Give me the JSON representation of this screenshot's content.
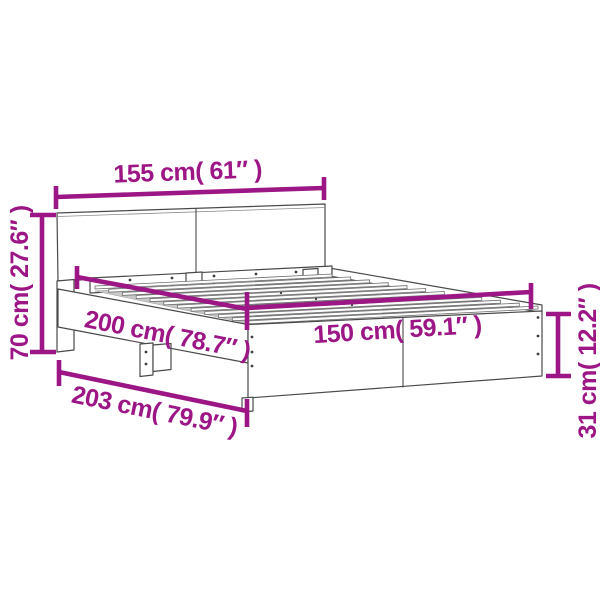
{
  "figure": {
    "subject": "Bed frame with headboard — product dimension diagram",
    "background_color": "#ffffff",
    "annotation_color": "#9c1685",
    "outline_color": "#4a4a4a"
  },
  "dimensions": [
    {
      "id": "headboard-width",
      "label": "155 cm( 61″ )",
      "value_cm": 155,
      "value_inch": 61,
      "placement": "top-horizontal"
    },
    {
      "id": "headboard-height",
      "label": "70 cm( 27.6″ )",
      "value_cm": 70,
      "value_inch": 27.6,
      "placement": "left-vertical"
    },
    {
      "id": "frame-length",
      "label": "200 cm( 78.7″ )",
      "value_cm": 200,
      "value_inch": 78.7,
      "placement": "side-rail-diagonal"
    },
    {
      "id": "bed-width",
      "label": "150 cm( 59.1″ )",
      "value_cm": 150,
      "value_inch": 59.1,
      "placement": "foot-horizontal"
    },
    {
      "id": "overall-length",
      "label": "203 cm( 79.9″ )",
      "value_cm": 203,
      "value_inch": 79.9,
      "placement": "bottom-diagonal"
    },
    {
      "id": "side-rail-height",
      "label": "31 cm( 12.2″ )",
      "value_cm": 31,
      "value_inch": 12.2,
      "placement": "right-vertical"
    }
  ]
}
